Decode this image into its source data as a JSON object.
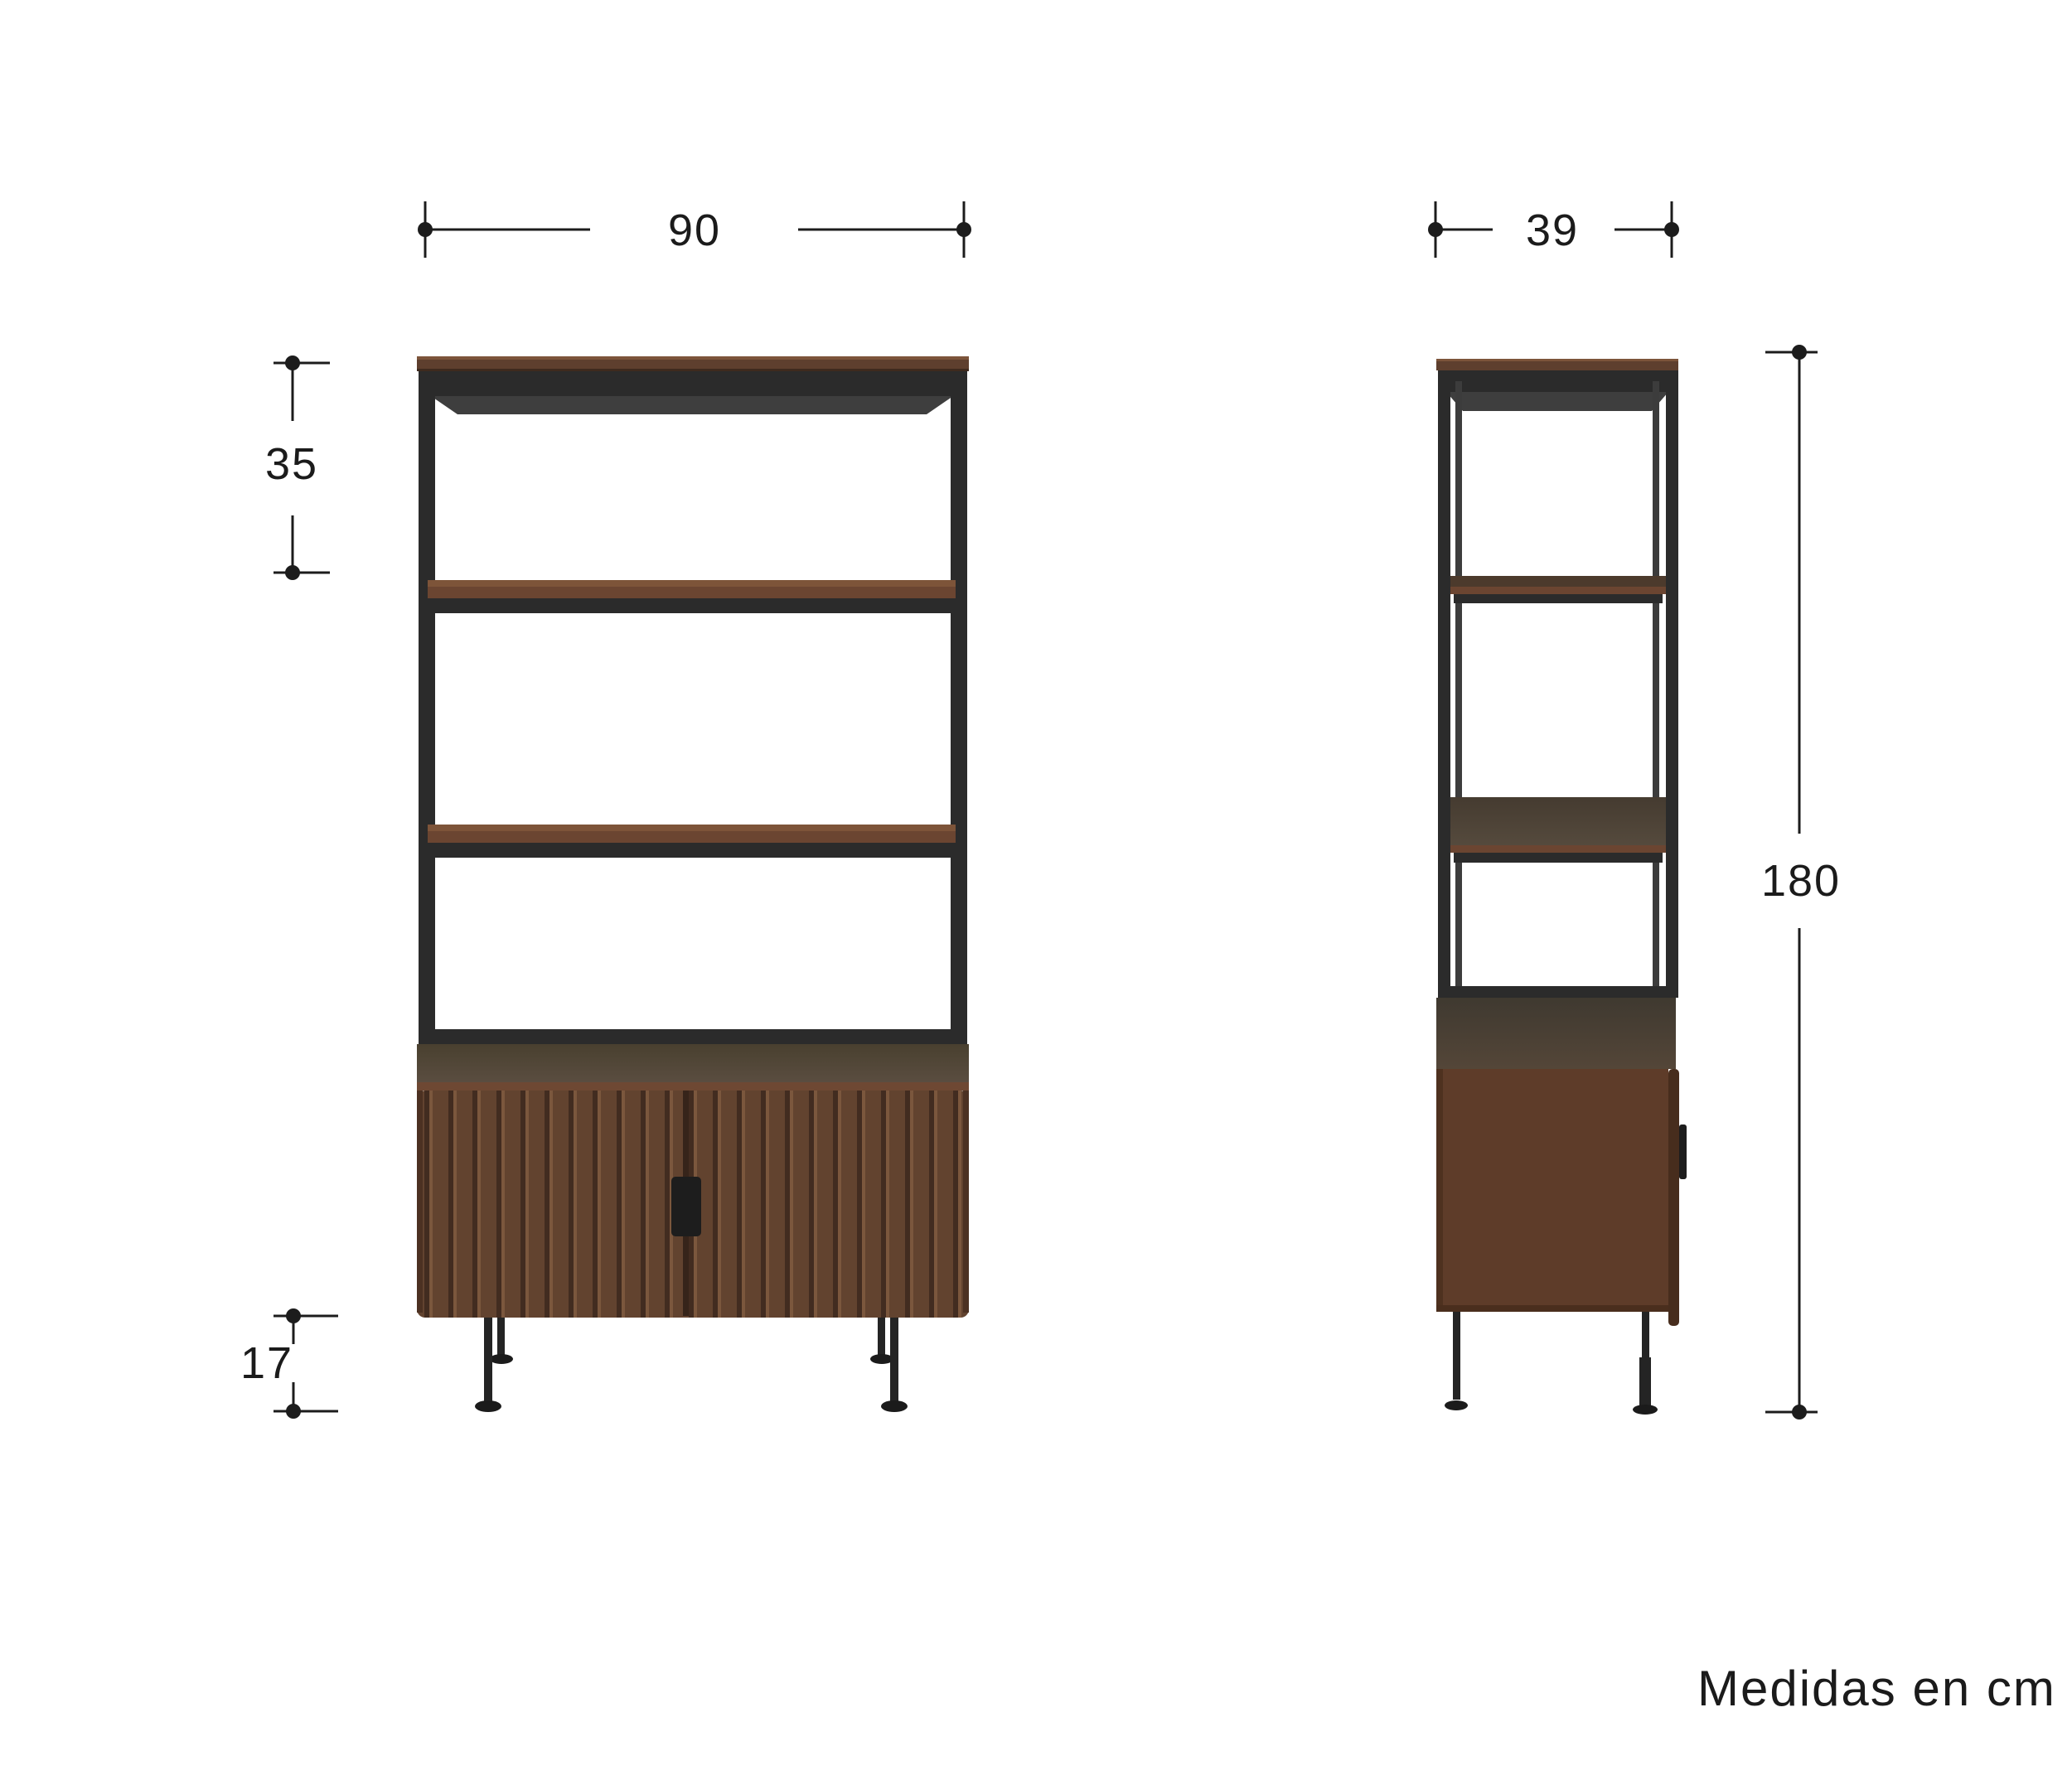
{
  "title": "Estante con puertas - diagrama de medidas",
  "caption": "Medidas en cm",
  "dimensions": {
    "front_width_cm": "90",
    "side_depth_cm": "39",
    "top_section_height_cm": "35",
    "leg_height_cm": "17",
    "total_height_cm": "180"
  },
  "colors": {
    "background": "#ffffff",
    "annotation_line": "#1c1c1c",
    "metal_frame": "#2b2b2b",
    "wood_top": "#5e3f2e",
    "wood_shelf_face": "#6b4531",
    "wood_shelf_edge": "#7d5439",
    "cabinet_top_surface": "#4e4335",
    "door_wood": "#62432f",
    "door_groove": "#422c20",
    "door_ridge": "#7b573d",
    "side_panel_wood": "#5e3c29"
  }
}
